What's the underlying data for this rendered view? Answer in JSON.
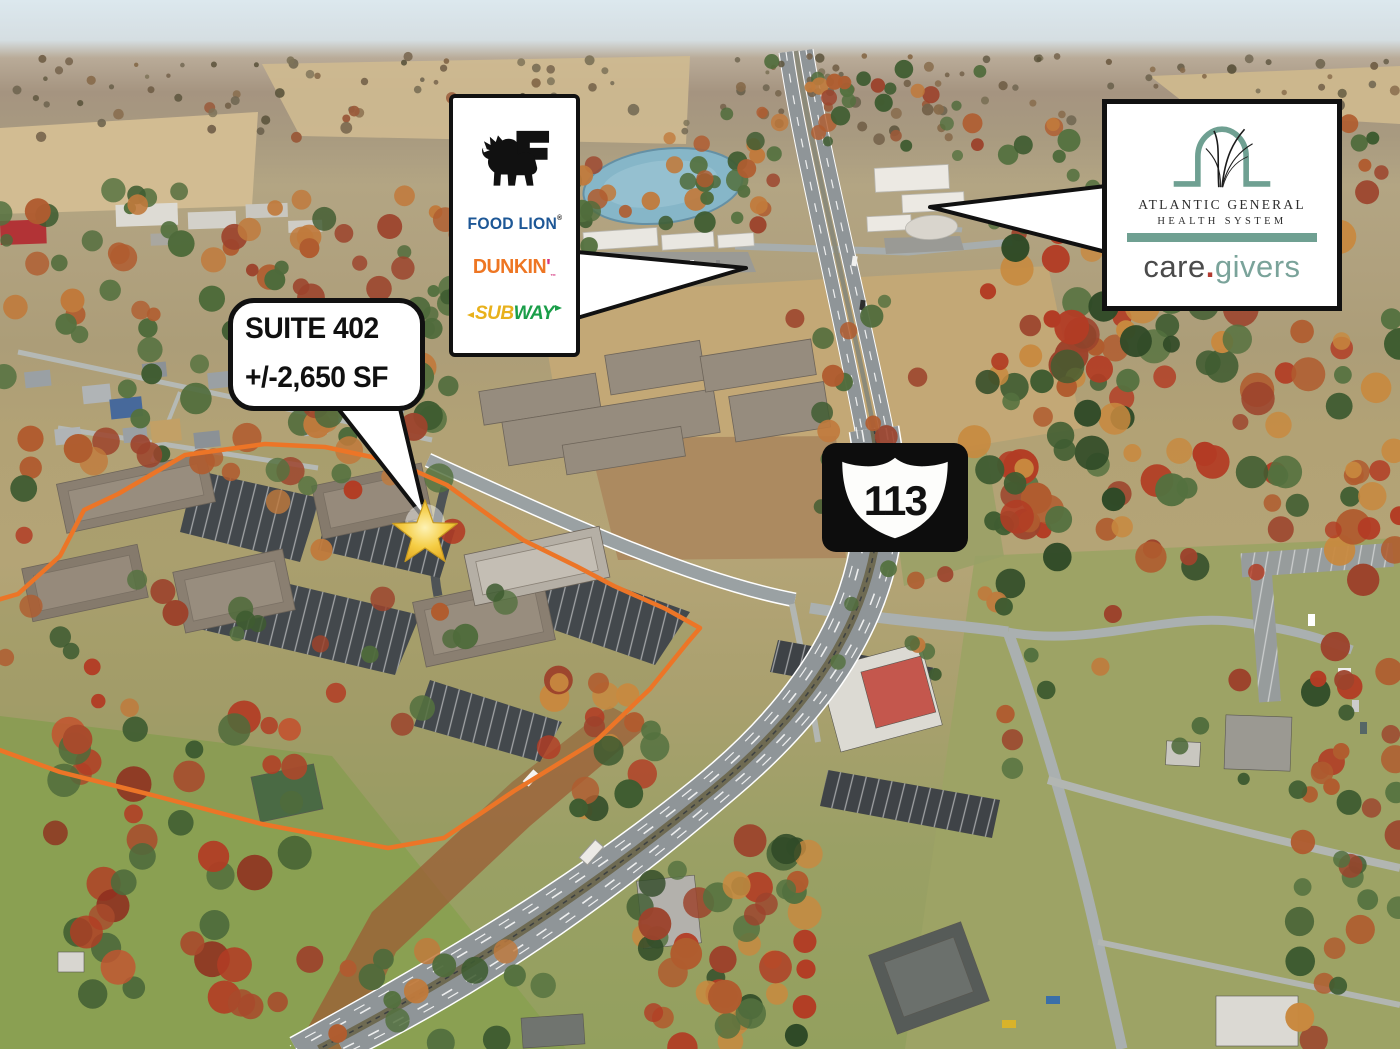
{
  "annotations": {
    "suite_bubble": {
      "line1": "SUITE 402",
      "line2": "+/-2,650 SF"
    },
    "brands_callout": {
      "food_lion": "FOOD LION",
      "food_lion_reg": "®",
      "dunkin": "DUNKIN",
      "dunkin_apostrophe": "'",
      "dunkin_tm": "™",
      "subway_sub": "SUB",
      "subway_way": "WAY"
    },
    "health_callout": {
      "line1": "ATLANTIC GENERAL",
      "line2": "HEALTH SYSTEM",
      "care": "care",
      "dot": ".",
      "givers": "givers"
    },
    "route_shield": {
      "number": "113"
    }
  },
  "colors": {
    "food_lion_blue": "#1d5796",
    "dunkin_orange": "#ee7623",
    "dunkin_pink": "#d5367f",
    "subway_yellow": "#e8b11c",
    "subway_green": "#1a9e49",
    "ag_teal": "#6fa092",
    "care_gray": "#4b4b4b",
    "care_dot_red": "#b23a30",
    "care_givers_teal": "#7aa39a",
    "boundary_orange": "#ec7527",
    "star_gold": "#f2c53d",
    "shield_bg": "#0d0d0d"
  }
}
